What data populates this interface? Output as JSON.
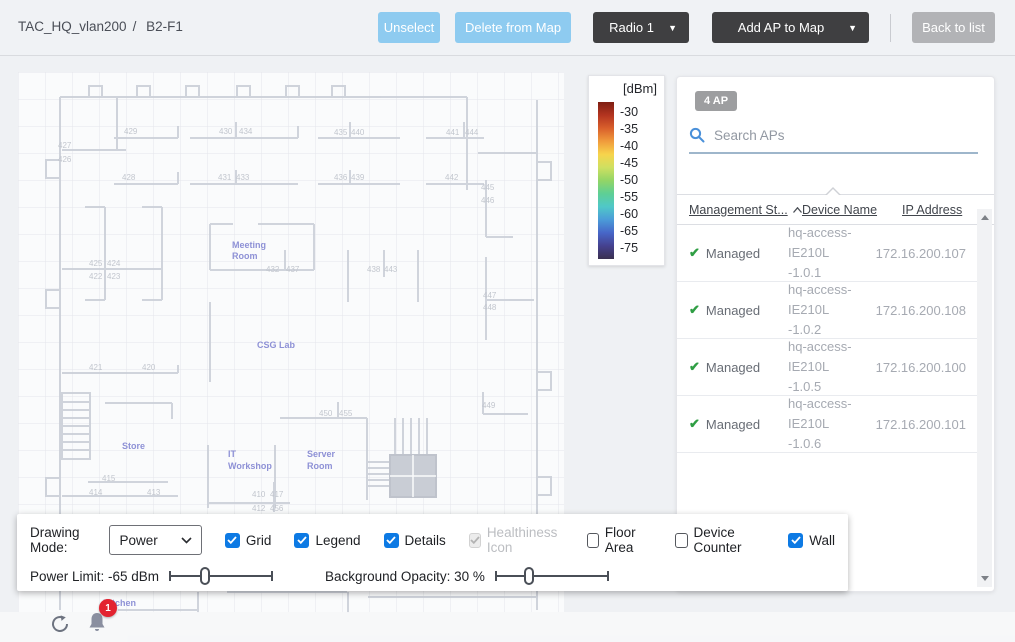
{
  "header": {
    "breadcrumb": {
      "map": "TAC_HQ_vlan200",
      "sep": "/",
      "floor": "B2-F1"
    },
    "buttons": {
      "unselect": "Unselect",
      "delete": "Delete from Map",
      "radio": "Radio 1",
      "add_ap": "Add AP to Map",
      "back": "Back to list"
    }
  },
  "icons": {
    "caret_down": "▼"
  },
  "legend": {
    "title": "[dBm]",
    "ticks": [
      "-30",
      "-35",
      "-40",
      "-45",
      "-50",
      "-55",
      "-60",
      "-65",
      "-75"
    ],
    "colors": [
      "#7e1e12",
      "#b33420",
      "#d95f2b",
      "#f09b3c",
      "#f7d44c",
      "#cfe061",
      "#93d566",
      "#5ecf95",
      "#50c8c8",
      "#4b9bd8",
      "#4766c8",
      "#45418f",
      "#3a3050"
    ]
  },
  "map": {
    "room_labels": [
      [
        "Meeting",
        "Room"
      ],
      [
        "CSG Lab"
      ],
      [
        "Store"
      ],
      [
        "IT",
        "Workshop"
      ],
      [
        "Server",
        "Room"
      ],
      [
        "Kitchen"
      ]
    ],
    "room_numbers": [
      "427",
      "426",
      "429",
      "430",
      "434",
      "428",
      "431",
      "433",
      "435",
      "440",
      "441",
      "444",
      "436",
      "439",
      "442",
      "445",
      "446",
      "425",
      "424",
      "422",
      "423",
      "432",
      "437",
      "438",
      "443",
      "421",
      "420",
      "447",
      "448",
      "415",
      "414",
      "413",
      "450",
      "455",
      "449",
      "410",
      "417",
      "412",
      "456"
    ]
  },
  "ap_panel": {
    "count_badge": "4 AP",
    "search_placeholder": "Search APs",
    "columns": [
      "Management St...",
      "Device Name",
      "IP Address"
    ],
    "rows": [
      {
        "status": "Managed",
        "device": [
          "hq-access-IE210L",
          "-1.0.1"
        ],
        "ip": "172.16.200.107"
      },
      {
        "status": "Managed",
        "device": [
          "hq-access-IE210L",
          "-1.0.2"
        ],
        "ip": "172.16.200.108"
      },
      {
        "status": "Managed",
        "device": [
          "hq-access-IE210L",
          "-1.0.5"
        ],
        "ip": "172.16.200.100"
      },
      {
        "status": "Managed",
        "device": [
          "hq-access-IE210L",
          "-1.0.6"
        ],
        "ip": "172.16.200.101"
      }
    ]
  },
  "controls": {
    "drawing_mode_label": "Drawing Mode:",
    "drawing_mode_value": "Power",
    "checkboxes": [
      {
        "label": "Grid",
        "state": "checked"
      },
      {
        "label": "Legend",
        "state": "checked"
      },
      {
        "label": "Details",
        "state": "checked"
      },
      {
        "label": "Healthiness Icon",
        "state": "checked-disabled"
      },
      {
        "label": "Floor Area",
        "state": "unchecked"
      },
      {
        "label": "Device Counter",
        "state": "unchecked"
      },
      {
        "label": "Wall",
        "state": "checked"
      }
    ],
    "power_limit": {
      "label": "Power Limit: -65 dBm",
      "value_pct": 35
    },
    "background_opacity": {
      "label": "Background Opacity: 30 %",
      "value_pct": 30
    }
  },
  "footer": {
    "notification_count": "1"
  }
}
